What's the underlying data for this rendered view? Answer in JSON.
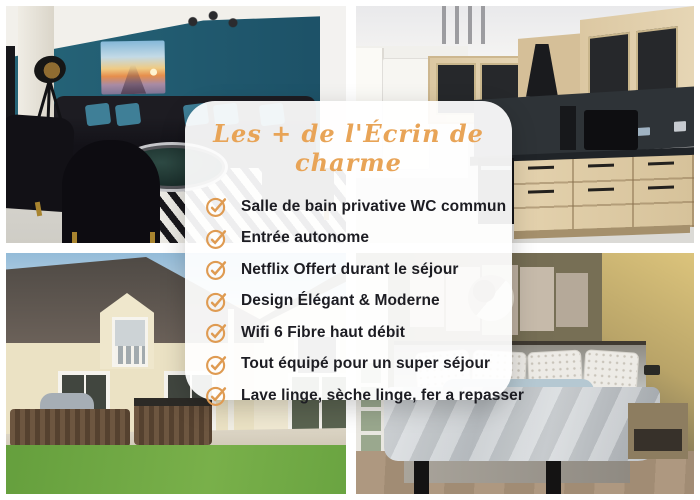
{
  "card": {
    "title": "Les + de l'Écrin de charme",
    "items": [
      "Salle de bain privative WC commun",
      "Entrée autonome",
      "Netflix Offert durant le séjour",
      "Design Élégant & Moderne",
      "Wifi 6 Fibre haut débit",
      "Tout équipé pour un super séjour",
      "Lave linge, sèche linge, fer a repasser"
    ],
    "check_icon": "check-circle-icon"
  },
  "colors": {
    "accent_orange": "#DF9B52",
    "title_orange": "#E8A457",
    "text_dark": "#1D1D23",
    "card_background": "rgba(255,255,255,0.93)"
  },
  "photos": {
    "top_left": "living-room",
    "top_right": "kitchen",
    "bottom_left": "house-exterior-garden",
    "bottom_right": "bedroom"
  }
}
